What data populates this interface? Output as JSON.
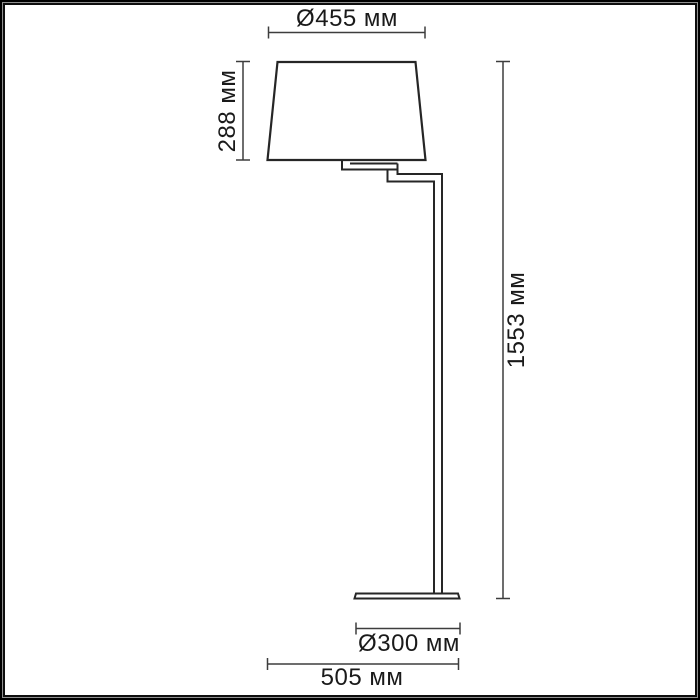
{
  "diagram": {
    "kind": "dimension-drawing",
    "subject": "floor-lamp",
    "units": "мм",
    "labels": {
      "shade_diameter": "Ø455 мм",
      "shade_height": "288 мм",
      "total_height": "1553 мм",
      "base_diameter": "Ø300 мм",
      "overall_width": "505 мм"
    },
    "values": {
      "shade_diameter_mm": 455,
      "shade_height_mm": 288,
      "total_height_mm": 1553,
      "base_diameter_mm": 300,
      "overall_width_mm": 505
    },
    "colors": {
      "outline": "#262626",
      "dimension_line": "#3d3d3d",
      "text": "#1a1a1a",
      "frame": "#000000",
      "background": "#ffffff"
    }
  }
}
